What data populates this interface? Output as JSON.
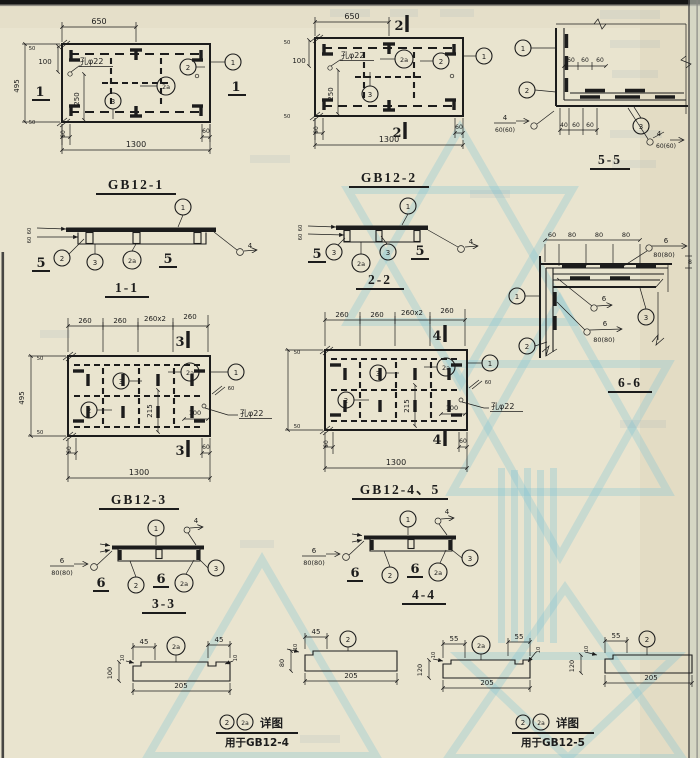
{
  "colors": {
    "ink": "#1c1c1c",
    "paper": "#e9e4cf",
    "paper_edge": "#ded6bc",
    "watermark": "#7fc3d5"
  },
  "drawing": {
    "gb12_1": {
      "title": "GB12-1",
      "dim_top": "650",
      "dim_bottom": "1300",
      "dim_left": "495",
      "dim_100": "100",
      "dim_250": "250",
      "hole_label": "孔φ22",
      "edge_top": "50",
      "edge_bottom": "50",
      "edge_bl": "60",
      "edge_br": "60",
      "sec_left": "1",
      "sec_right": "1",
      "c1": "1",
      "c2": "2",
      "c2a": "2a",
      "c3": "3"
    },
    "gb12_2": {
      "title": "GB12-2",
      "dim_top": "650",
      "dim_bottom": "1300",
      "dim_100": "100",
      "dim_250": "250",
      "hole_label": "孔φ22",
      "edge_top": "50",
      "edge_bottom": "50",
      "edge_bl": "60",
      "edge_br": "60",
      "sec_top": "2",
      "sec_bottom": "2",
      "c1": "1",
      "c2": "2",
      "c2a": "2a",
      "c3": "3"
    },
    "s55": {
      "title": "5-5",
      "c1": "1",
      "c2": "2",
      "c3": "3",
      "top_dims": [
        "60",
        "60",
        "60"
      ],
      "bot_dims": [
        "40",
        "60",
        "60"
      ],
      "weld_left_size": "4",
      "weld_left_len": "60(60)",
      "weld_right_size": "4",
      "weld_right_len": "60(60)"
    },
    "s11": {
      "title": "1-1",
      "sec_left": "5",
      "sec_right": "5",
      "c1": "1",
      "c2": "2",
      "c3": "3",
      "c2a": "2a",
      "weld_size": "4",
      "t1": "60",
      "t2": "60"
    },
    "s22": {
      "title": "2-2",
      "sec_left": "5",
      "sec_right": "5",
      "c1": "1",
      "c3l": "3",
      "c2a": "2a",
      "c3r": "3",
      "weld_size": "4",
      "t1": "60",
      "t2": "60"
    },
    "s66": {
      "title": "6-6",
      "top_dims": [
        "60",
        "80",
        "80",
        "80"
      ],
      "c1": "1",
      "c2": "2",
      "c3": "3",
      "weld_top_size": "6",
      "weld_top_len": "80(80)",
      "weld_mid_size": "6",
      "weld_bot_size": "6",
      "weld_bot_len": "80(80)",
      "thickness": "8"
    },
    "gb12_3": {
      "title": "GB12-3",
      "top_dims": [
        "260",
        "260",
        "260x2",
        "260"
      ],
      "dim_left": "495",
      "dim_215": "215",
      "dim_100": "100",
      "hole_label": "孔φ22",
      "dim_bottom": "1300",
      "edge_top": "50",
      "edge_bottom": "50",
      "edge_bl": "60",
      "edge_br": "60",
      "edge_right": "60",
      "sec_top": "3",
      "sec_bottom": "3",
      "c1": "1",
      "c2": "2",
      "c2a": "2a",
      "c3": "3"
    },
    "gb12_45": {
      "title": "GB12-4、5",
      "top_dims": [
        "260",
        "260",
        "260x2",
        "260"
      ],
      "dim_215": "215",
      "dim_100": "100",
      "hole_label": "孔φ22",
      "dim_bottom": "1300",
      "edge_top": "50",
      "edge_bottom": "50",
      "edge_bl": "60",
      "edge_br": "60",
      "edge_right": "60",
      "sec_top": "4",
      "sec_bottom": "4",
      "c1": "1",
      "c2": "2",
      "c2a": "2a",
      "c3": "3"
    },
    "s33": {
      "title": "3-3",
      "sec_left": "6",
      "sec_mid": "6",
      "c1": "1",
      "c2": "2",
      "c2a": "2a",
      "c3": "3",
      "weld_top_size": "4",
      "weld_size": "6",
      "weld_len": "80(80)"
    },
    "s44": {
      "title": "4-4",
      "sec_left": "6",
      "sec_mid": "6",
      "c1": "1",
      "c2": "2",
      "c2a": "2a",
      "c3": "3",
      "weld_top_size": "4",
      "weld_size": "6",
      "weld_len": "80(80)"
    },
    "det4": {
      "p1": {
        "d_left": "45",
        "d_right": "45",
        "callout": "2a",
        "height": "100",
        "width": "205",
        "notch": "10"
      },
      "p2": {
        "d_left": "45",
        "callout": "2",
        "height": "80",
        "width": "205",
        "notch": "10"
      },
      "cap_c2": "2",
      "cap_c2a": "2a",
      "cap_label": "详图",
      "cap_use": "用于GB12-4"
    },
    "det5": {
      "p1": {
        "d_left": "55",
        "d_right": "55",
        "callout": "2a",
        "height": "120",
        "width": "205",
        "notch": "10"
      },
      "p2": {
        "d_left": "55",
        "callout": "2",
        "height": "120",
        "width": "205",
        "notch": "10"
      },
      "cap_c2": "2",
      "cap_c2a": "2a",
      "cap_label": "详图",
      "cap_use": "用于GB12-5"
    }
  }
}
